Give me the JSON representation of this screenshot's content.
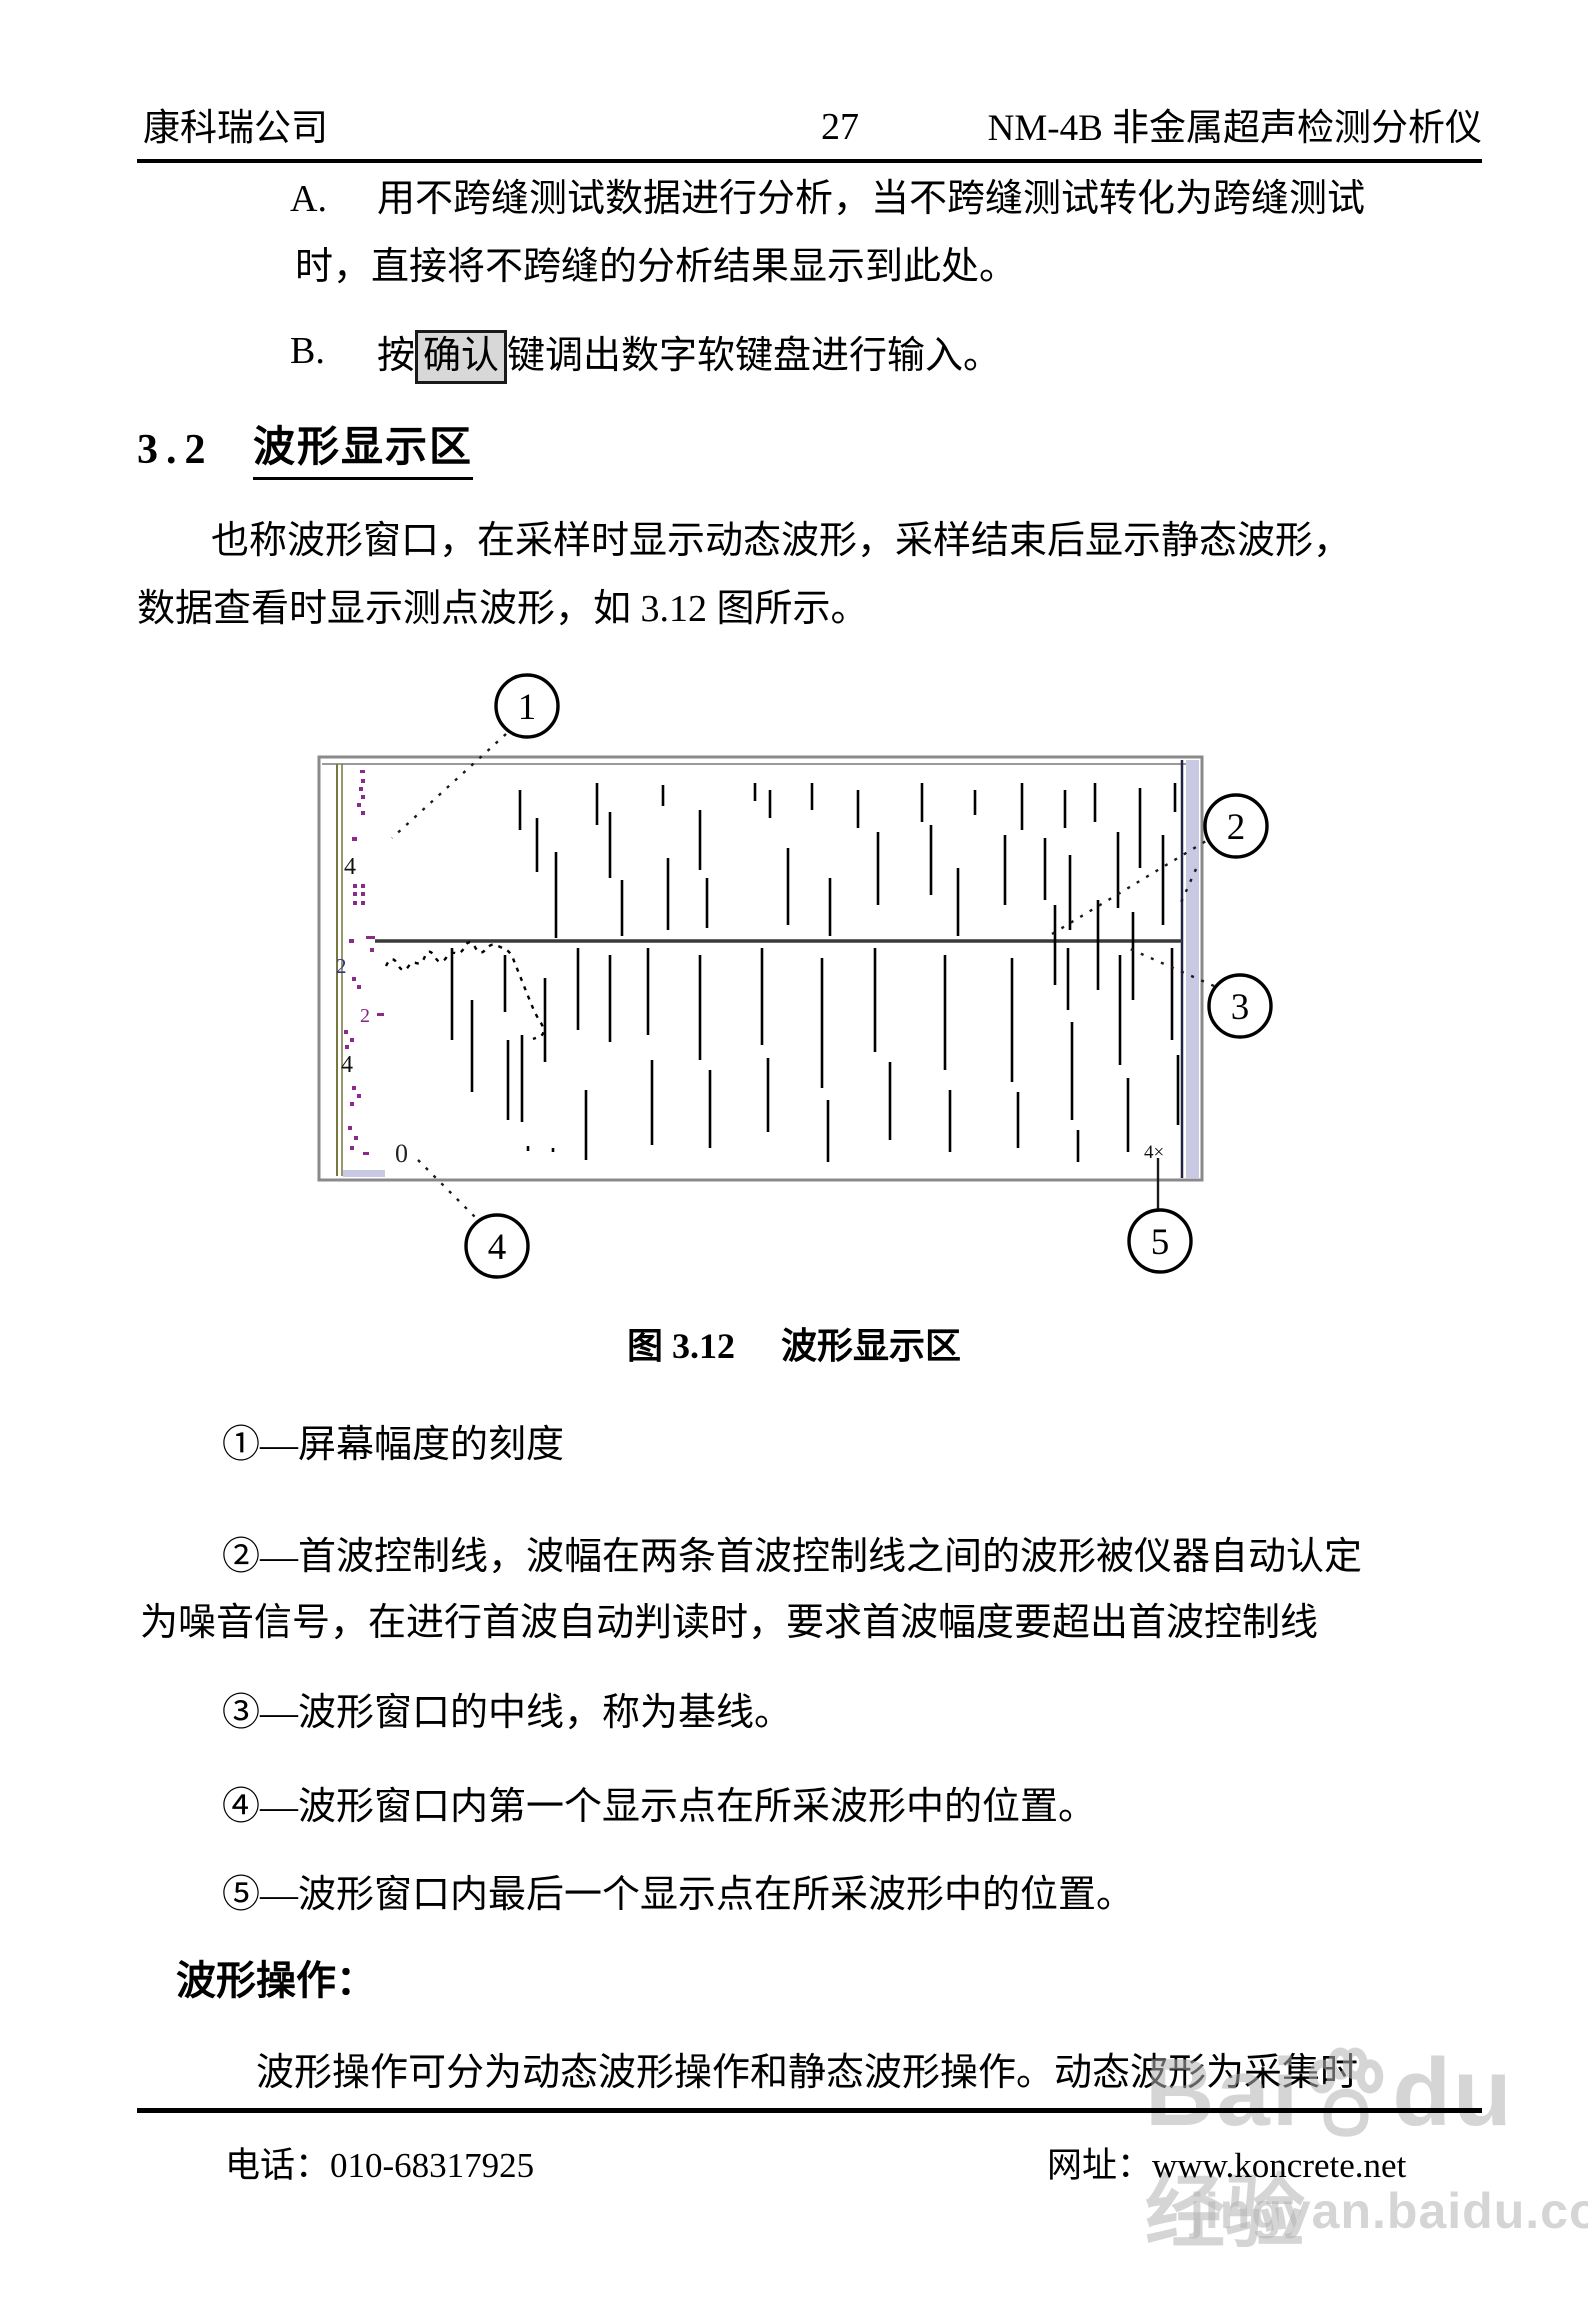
{
  "header": {
    "company": "康科瑞公司",
    "page_number": "27",
    "device": "NM-4B 非金属超声检测分析仪"
  },
  "items": {
    "a_label": "A.",
    "a_line1": "用不跨缝测试数据进行分析，当不跨缝测试转化为跨缝测试",
    "a_line2": "时，直接将不跨缝的分析结果显示到此处。",
    "b_label": "B.",
    "b_prefix": "按",
    "b_key": "确认",
    "b_suffix": "键调出数字软键盘进行输入。"
  },
  "section": {
    "number": "3.2",
    "title": "波形显示区"
  },
  "intro": {
    "line1": "也称波形窗口，在采样时显示动态波形，采样结束后显示静态波形，",
    "line2": "数据查看时显示测点波形，如 3.12 图所示。"
  },
  "figure": {
    "caption_prefix": "图 3.12",
    "caption_title": "波形显示区",
    "zero_label": "0",
    "end_label": "4×",
    "scale_labels": [
      {
        "t": "4",
        "x": 344,
        "y": 874,
        "size": 24,
        "color": "#111111"
      },
      {
        "t": "2",
        "x": 336,
        "y": 973,
        "size": 21,
        "color": "#333388"
      },
      {
        "t": "2",
        "x": 360,
        "y": 1022,
        "size": 20,
        "color": "#882288"
      },
      {
        "t": "4",
        "x": 341,
        "y": 1072,
        "size": 24,
        "color": "#111111"
      }
    ],
    "scale_marks": [
      [
        360,
        770,
        5,
        3
      ],
      [
        361,
        779,
        4,
        4
      ],
      [
        359,
        787,
        4,
        4
      ],
      [
        361,
        795,
        4,
        4
      ],
      [
        357,
        803,
        4,
        4
      ],
      [
        361,
        811,
        4,
        4
      ],
      [
        352,
        837,
        5,
        4
      ],
      [
        353,
        884,
        4,
        4
      ],
      [
        361,
        884,
        4,
        4
      ],
      [
        353,
        892,
        4,
        4
      ],
      [
        361,
        892,
        4,
        4
      ],
      [
        353,
        901,
        4,
        4
      ],
      [
        361,
        901,
        4,
        4
      ],
      [
        366,
        936,
        9,
        3
      ],
      [
        349,
        939,
        5,
        4
      ],
      [
        370,
        948,
        4,
        4
      ],
      [
        352,
        977,
        4,
        4
      ],
      [
        357,
        985,
        4,
        4
      ],
      [
        377,
        1013,
        7,
        3
      ],
      [
        344,
        1030,
        4,
        4
      ],
      [
        350,
        1038,
        4,
        4
      ],
      [
        345,
        1045,
        4,
        4
      ],
      [
        352,
        1086,
        4,
        4
      ],
      [
        357,
        1094,
        4,
        4
      ],
      [
        350,
        1102,
        4,
        4
      ],
      [
        348,
        1126,
        4,
        4
      ],
      [
        354,
        1136,
        4,
        4
      ],
      [
        350,
        1146,
        4,
        4
      ],
      [
        363,
        1152,
        6,
        3
      ]
    ],
    "strokes": [
      [
        520,
        790,
        830
      ],
      [
        537,
        818,
        872
      ],
      [
        556,
        852,
        938
      ],
      [
        597,
        783,
        825
      ],
      [
        610,
        812,
        878
      ],
      [
        622,
        880,
        936
      ],
      [
        663,
        785,
        806
      ],
      [
        668,
        858,
        930
      ],
      [
        700,
        810,
        870
      ],
      [
        707,
        878,
        928
      ],
      [
        755,
        783,
        801
      ],
      [
        770,
        790,
        818
      ],
      [
        788,
        848,
        925
      ],
      [
        812,
        783,
        810
      ],
      [
        830,
        878,
        936
      ],
      [
        858,
        790,
        828
      ],
      [
        878,
        832,
        905
      ],
      [
        922,
        783,
        822
      ],
      [
        931,
        825,
        895
      ],
      [
        958,
        868,
        936
      ],
      [
        975,
        790,
        815
      ],
      [
        1005,
        835,
        905
      ],
      [
        1022,
        783,
        830
      ],
      [
        1045,
        838,
        900
      ],
      [
        1065,
        790,
        828
      ],
      [
        1070,
        855,
        930
      ],
      [
        1095,
        783,
        822
      ],
      [
        1118,
        832,
        908
      ],
      [
        1140,
        788,
        868
      ],
      [
        1163,
        835,
        925
      ],
      [
        1175,
        783,
        812
      ],
      [
        1055,
        905,
        985
      ],
      [
        1098,
        900,
        990
      ],
      [
        1133,
        912,
        1000
      ],
      [
        452,
        948,
        1040
      ],
      [
        472,
        1000,
        1092
      ],
      [
        505,
        955,
        1012
      ],
      [
        508,
        1040,
        1120
      ],
      [
        522,
        1035,
        1122
      ],
      [
        545,
        978,
        1062
      ],
      [
        578,
        948,
        1030
      ],
      [
        586,
        1090,
        1160
      ],
      [
        610,
        955,
        1042
      ],
      [
        648,
        948,
        1035
      ],
      [
        652,
        1060,
        1145
      ],
      [
        700,
        955,
        1060
      ],
      [
        710,
        1070,
        1148
      ],
      [
        762,
        948,
        1045
      ],
      [
        768,
        1058,
        1132
      ],
      [
        822,
        958,
        1088
      ],
      [
        828,
        1100,
        1162
      ],
      [
        875,
        948,
        1052
      ],
      [
        890,
        1062,
        1140
      ],
      [
        945,
        955,
        1070
      ],
      [
        950,
        1090,
        1152
      ],
      [
        1012,
        958,
        1082
      ],
      [
        1018,
        1092,
        1148
      ],
      [
        1068,
        948,
        1010
      ],
      [
        1072,
        1022,
        1120
      ],
      [
        1078,
        1130,
        1162
      ],
      [
        1120,
        955,
        1065
      ],
      [
        1128,
        1078,
        1152
      ],
      [
        1172,
        948,
        1040
      ],
      [
        1178,
        1055,
        1125
      ],
      [
        528,
        1146,
        1151
      ],
      [
        553,
        1148,
        1152
      ]
    ],
    "trace_path": "M386 966 q6 -13 12 -1 q5 9 10 2 q4 -6 8 -4 q6 2 9 -7 q4 -9 10 1 q5 9 11 1 q4 -6 9 -5 q6 2 10 -7 q5 -8 10 1 q5 10 11 2 q6 -7 12 -3 l7 3 q6 3 9 12 l16 40 q6 15 11 22 q5 9 0 13 l-8 3",
    "callouts": [
      {
        "n": "1",
        "cx": 527,
        "cy": 706
      },
      {
        "n": "2",
        "cx": 1236,
        "cy": 826
      },
      {
        "n": "3",
        "cx": 1240,
        "cy": 1006
      },
      {
        "n": "4",
        "cx": 497,
        "cy": 1246
      },
      {
        "n": "5",
        "cx": 1160,
        "cy": 1241
      }
    ],
    "leaders": [
      {
        "x1": 506,
        "y1": 734,
        "x2": 392,
        "y2": 838,
        "dash": true
      },
      {
        "x1": 1052,
        "y1": 934,
        "x2": 1206,
        "y2": 841,
        "dash": true
      },
      {
        "x1": 1196,
        "y1": 869,
        "x2": 1179,
        "y2": 907,
        "dash": true
      },
      {
        "x1": 1214,
        "y1": 986,
        "x2": 1128,
        "y2": 948,
        "dash": true
      },
      {
        "x1": 418,
        "y1": 1160,
        "x2": 475,
        "y2": 1217,
        "dash": true
      },
      {
        "x1": 1158,
        "y1": 1158,
        "x2": 1158,
        "y2": 1211,
        "dash": false
      }
    ]
  },
  "explanations": [
    {
      "line1": "①—屏幕幅度的刻度",
      "line2": ""
    },
    {
      "line1": "②—首波控制线，波幅在两条首波控制线之间的波形被仪器自动认定",
      "line2": "为噪音信号，在进行首波自动判读时，要求首波幅度要超出首波控制线"
    },
    {
      "line1": "③—波形窗口的中线，称为基线。",
      "line2": ""
    },
    {
      "line1": "④—波形窗口内第一个显示点在所采波形中的位置。",
      "line2": ""
    },
    {
      "line1": "⑤—波形窗口内最后一个显示点在所采波形中的位置。",
      "line2": ""
    }
  ],
  "operation": {
    "heading": "波形操作：",
    "paragraph": "波形操作可分为动态波形操作和静态波形操作。动态波形为采集时"
  },
  "footer": {
    "phone": "电话：010-68317925",
    "website": "网址：www.koncrete.net"
  },
  "watermark": {
    "brand_left": "Bai",
    "brand_right": "du",
    "brand_cn": "经验",
    "url": "jingyan.baidu.com"
  }
}
